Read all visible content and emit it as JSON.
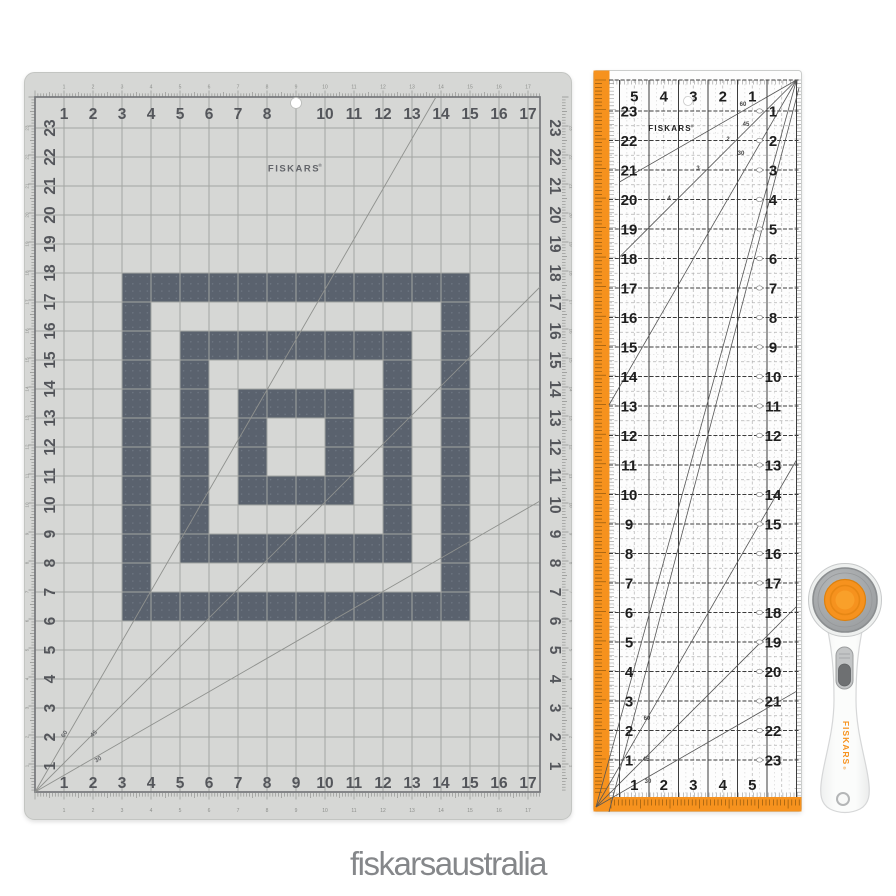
{
  "page": {
    "background": "#ffffff",
    "brand_text": "fiskarsaustralia",
    "brand_color": "#85878a"
  },
  "mat": {
    "brand": "FISKARS",
    "brand_reg": "®",
    "colors": {
      "base": "#d6d7d5",
      "edge_stroke": "#c3c5c2",
      "grid_line": "#a3a5a2",
      "grid_border": "#75777a",
      "number": "#54565b",
      "tiny_number": "#8b8d8a",
      "dark_cell": "#5a626e",
      "dark_cell_dot": "#727b87",
      "diagonal": "#8f918e",
      "tick": "#8e908d",
      "logo": "#63656a"
    },
    "edge_numbers": [
      "1",
      "2",
      "3",
      "4",
      "5",
      "6",
      "7",
      "8",
      "9",
      "10",
      "11",
      "12",
      "13",
      "14",
      "15",
      "16",
      "17"
    ],
    "hole_replaces": "9",
    "side_numbers": [
      "23",
      "22",
      "21",
      "20",
      "19",
      "18",
      "17",
      "16",
      "15",
      "14",
      "13",
      "12",
      "11",
      "10",
      "9",
      "8",
      "7",
      "6",
      "5",
      "4",
      "3",
      "2",
      "1"
    ],
    "angle_labels": [
      "60",
      "45",
      "30"
    ],
    "pattern_rows": [
      "111111111111",
      "100000000001",
      "101111111101",
      "101000000101",
      "101011110101",
      "101010010101",
      "101010010101",
      "101011110101",
      "101000000101",
      "101111111101",
      "100000000001",
      "111111111111"
    ]
  },
  "ruler": {
    "brand": "FISKARS",
    "brand_reg": "®",
    "colors": {
      "orange": "#f6921e",
      "orange_tick": "#5d3a04",
      "body": "#fdfdfd",
      "body_edge": "#cbcdcc",
      "line": "#3c3c3c",
      "sub_line": "#b2b2b2",
      "quarter_line": "#d2d2d2",
      "number": "#1e1e1e",
      "diagonal": "#565656",
      "diag_label": "#454545",
      "marker": "#8f8f8f"
    },
    "top_numbers": [
      "5",
      "4",
      "3",
      "2",
      "1"
    ],
    "bottom_numbers": [
      "1",
      "2",
      "3",
      "4",
      "5"
    ],
    "left_numbers": [
      "23",
      "22",
      "21",
      "20",
      "19",
      "18",
      "17",
      "16",
      "15",
      "14",
      "13",
      "12",
      "11",
      "10",
      "9",
      "8",
      "7",
      "6",
      "5",
      "4",
      "3",
      "2",
      "1"
    ],
    "right_numbers": [
      "1",
      "2",
      "3",
      "4",
      "5",
      "6",
      "7",
      "8",
      "9",
      "10",
      "11",
      "12",
      "13",
      "14",
      "15",
      "16",
      "17",
      "18",
      "19",
      "20",
      "21",
      "22",
      "23"
    ],
    "angle_labels_top": [
      "60",
      "45",
      "30"
    ],
    "angle_labels_bottom": [
      "60",
      "45",
      "30"
    ],
    "diag_numbers": [
      "2",
      "3",
      "4"
    ]
  },
  "cutter": {
    "brand": "FISKARS",
    "brand_reg": "®",
    "colors": {
      "body": "#fbfcfb",
      "body_edge": "#d6d7d8",
      "rim": "#eef0ef",
      "rim_edge": "#c7c9ca",
      "blade": "#a2a5a7",
      "blade_edge": "#8b8e90",
      "orange": "#f6921e",
      "orange_dark": "#dd810e",
      "orange_light": "#f9a02a",
      "slider_light": "#c3c5c6",
      "slider_dark": "#6e7072",
      "slider_edge": "#9c9e9f",
      "text": "#f6921e",
      "hole_edge": "#b4b6b7"
    }
  }
}
